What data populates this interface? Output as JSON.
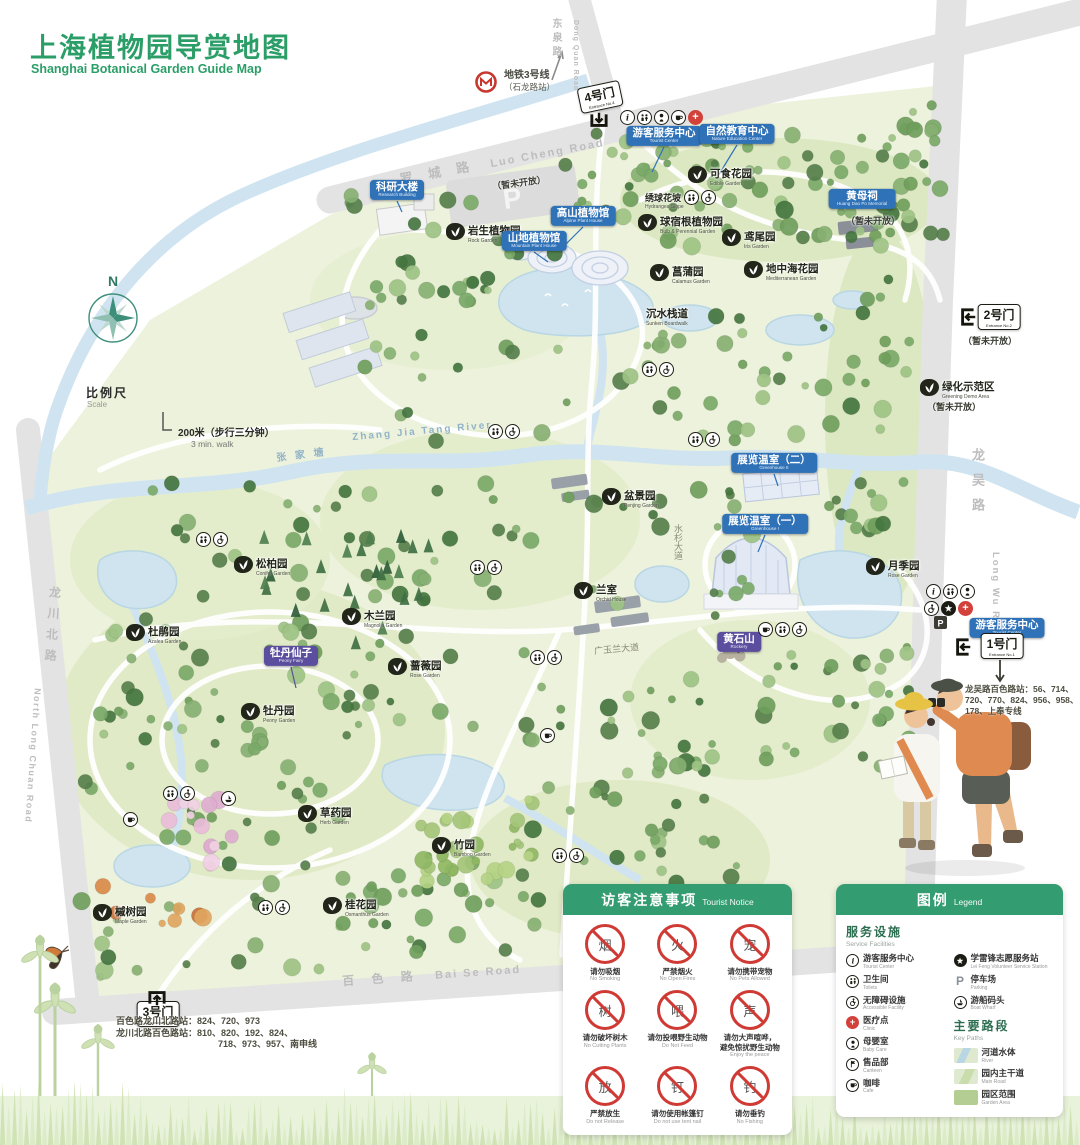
{
  "title": {
    "zh": "上海植物园导赏地图",
    "en": "Shanghai Botanical Garden Guide Map"
  },
  "metro": {
    "line": "地铁3号线",
    "station": "（石龙路站）"
  },
  "compass_n": "N",
  "scale": {
    "zh": "比例尺",
    "en": "Scale",
    "dist": "200米（步行三分钟）",
    "walk": "3 min. walk"
  },
  "roads": {
    "luocheng": {
      "zh": "罗 城 路",
      "en": "Luo Cheng Road"
    },
    "dongquan": {
      "zh": "东泉路",
      "en": "Dong Quan Road"
    },
    "longwu": {
      "zh": "龙吴路",
      "en": "Long Wu Road"
    },
    "longchuanbei": {
      "zh": "龙川北路",
      "en": "North Long Chuan Road"
    },
    "baise": {
      "zh": "百 色 路",
      "en": "Bai Se Road"
    },
    "shuishan": "水杉大道",
    "guangyulan": "广玉兰大道"
  },
  "river": {
    "zh": "张 家 塘",
    "en": "Zhang Jia Tang River"
  },
  "gates": [
    {
      "name": "4号门",
      "sub": "Entrance No.4"
    },
    {
      "name": "2号门",
      "sub": "Entrance No.2"
    },
    {
      "name": "1号门",
      "sub": "Entrance No.1"
    },
    {
      "name": "3号门",
      "sub": "Entrance No.3"
    }
  ],
  "notes": {
    "closed": "（暂未开放）"
  },
  "bus": {
    "gate1": {
      "l1": "龙吴路百色路站：56、714、",
      "l2": "720、770、824、956、958、",
      "l3": "178、上奉专线"
    },
    "gate3": {
      "l1": "百色路龙川北路站：824、720、973",
      "l2": "龙川北路百色路站：810、820、192、824、",
      "l3": "718、973、957、南申线"
    }
  },
  "map_icons": {
    "parking": "P"
  },
  "pois": {
    "blue": [
      {
        "zh": "科研大楼",
        "en": "Research Building"
      },
      {
        "zh": "游客服务中心",
        "en": "Tourist Center"
      },
      {
        "zh": "自然教育中心",
        "en": "Nature Education Center"
      },
      {
        "zh": "高山植物馆",
        "en": "Alpine Plant House"
      },
      {
        "zh": "山地植物馆",
        "en": "Mountain Plant House"
      },
      {
        "zh": "黄母祠",
        "en": "Huang Dao Po Memorial"
      },
      {
        "zh": "展览温室（二）",
        "en": "Greenhouse II"
      },
      {
        "zh": "展览温室（一）",
        "en": "Greenhouse I"
      },
      {
        "zh": "游客服务中心",
        "en": "Tourist Center"
      }
    ],
    "purple": [
      {
        "zh": "牡丹仙子",
        "en": "Peony Fairy"
      },
      {
        "zh": "黄石山",
        "en": "Rockery"
      }
    ],
    "dark": [
      {
        "zh": "岩生植物园",
        "en": "Rock Garden"
      },
      {
        "zh": "可食花园",
        "en": "Edible Garden"
      },
      {
        "zh": "绣球花坡",
        "en": "Hydrangea Slope"
      },
      {
        "zh": "球宿根植物园",
        "en": "Bulb & Perennial Garden"
      },
      {
        "zh": "鸢尾园",
        "en": "Iris Garden"
      },
      {
        "zh": "地中海花园",
        "en": "Mediterranean Garden"
      },
      {
        "zh": "菖蒲园",
        "en": "Calamus Garden"
      },
      {
        "zh": "沉水栈道",
        "en": "Sunken Boardwalk"
      },
      {
        "zh": "绿化示范区",
        "en": "Greening Demo Area"
      },
      {
        "zh": "松柏园",
        "en": "Conifer Garden"
      },
      {
        "zh": "杜鹃园",
        "en": "Azalea Garden"
      },
      {
        "zh": "木兰园",
        "en": "Magnolia Garden"
      },
      {
        "zh": "蔷薇园",
        "en": "Rose Garden"
      },
      {
        "zh": "牡丹园",
        "en": "Peony Garden"
      },
      {
        "zh": "盆景园",
        "en": "Penjing Garden"
      },
      {
        "zh": "兰室",
        "en": "Orchid House"
      },
      {
        "zh": "月季园",
        "en": "Rose Garden"
      },
      {
        "zh": "草药园",
        "en": "Herb Garden"
      },
      {
        "zh": "竹园",
        "en": "Bamboo Garden"
      },
      {
        "zh": "桂花园",
        "en": "Osmanthus Garden"
      },
      {
        "zh": "槭树园",
        "en": "Maple Garden"
      }
    ]
  },
  "notice": {
    "title_zh": "访客注意事项",
    "title_en": "Tourist Notice",
    "items": [
      {
        "zh": "请勿吸烟",
        "en": "No Smoking",
        "g": "烟"
      },
      {
        "zh": "严禁烟火",
        "en": "No Open Fires",
        "g": "火"
      },
      {
        "zh": "请勿携带宠物",
        "en": "No Pets Allowed",
        "g": "宠"
      },
      {
        "zh": "请勿破坏树木",
        "en": "No Cutting Plants",
        "g": "树"
      },
      {
        "zh": "请勿投喂野生动物",
        "en": "Do Not Feed",
        "g": "喂"
      },
      {
        "zh": "请勿大声喧哗，",
        "zh2": "避免惊扰野生动物",
        "en": "Enjoy the peace",
        "g": "声"
      },
      {
        "zh": "严禁放生",
        "en": "Do not Release",
        "g": "放"
      },
      {
        "zh": "请勿使用帐篷钉",
        "en": "Do not use tent nail",
        "g": "钉"
      },
      {
        "zh": "请勿垂钓",
        "en": "No Fishing",
        "g": "钓"
      }
    ]
  },
  "legend": {
    "title_zh": "图例",
    "title_en": "Legend",
    "service_zh": "服务设施",
    "service_en": "Service Facilities",
    "services": [
      {
        "zh": "游客服务中心",
        "en": "Tourist Center"
      },
      {
        "zh": "卫生间",
        "en": "Toilets"
      },
      {
        "zh": "无障碍设施",
        "en": "Accessible Facility"
      },
      {
        "zh": "医疗点",
        "en": "Clinic"
      },
      {
        "zh": "母婴室",
        "en": "Baby Care"
      },
      {
        "zh": "售品部",
        "en": "Canteen"
      },
      {
        "zh": "咖啡",
        "en": "Cafe"
      },
      {
        "zh": "学雷锋志愿服务站",
        "en": "Lei Feng Volunteer Service Station"
      },
      {
        "zh": "停车场",
        "en": "Parking"
      },
      {
        "zh": "游船码头",
        "en": "Boat Wharf"
      }
    ],
    "paths_zh": "主要路段",
    "paths_en": "Key Paths",
    "paths": [
      {
        "zh": "河道水体",
        "en": "River"
      },
      {
        "zh": "园内主干道",
        "en": "Main Road"
      },
      {
        "zh": "园区范围",
        "en": "Garden Area"
      }
    ]
  }
}
